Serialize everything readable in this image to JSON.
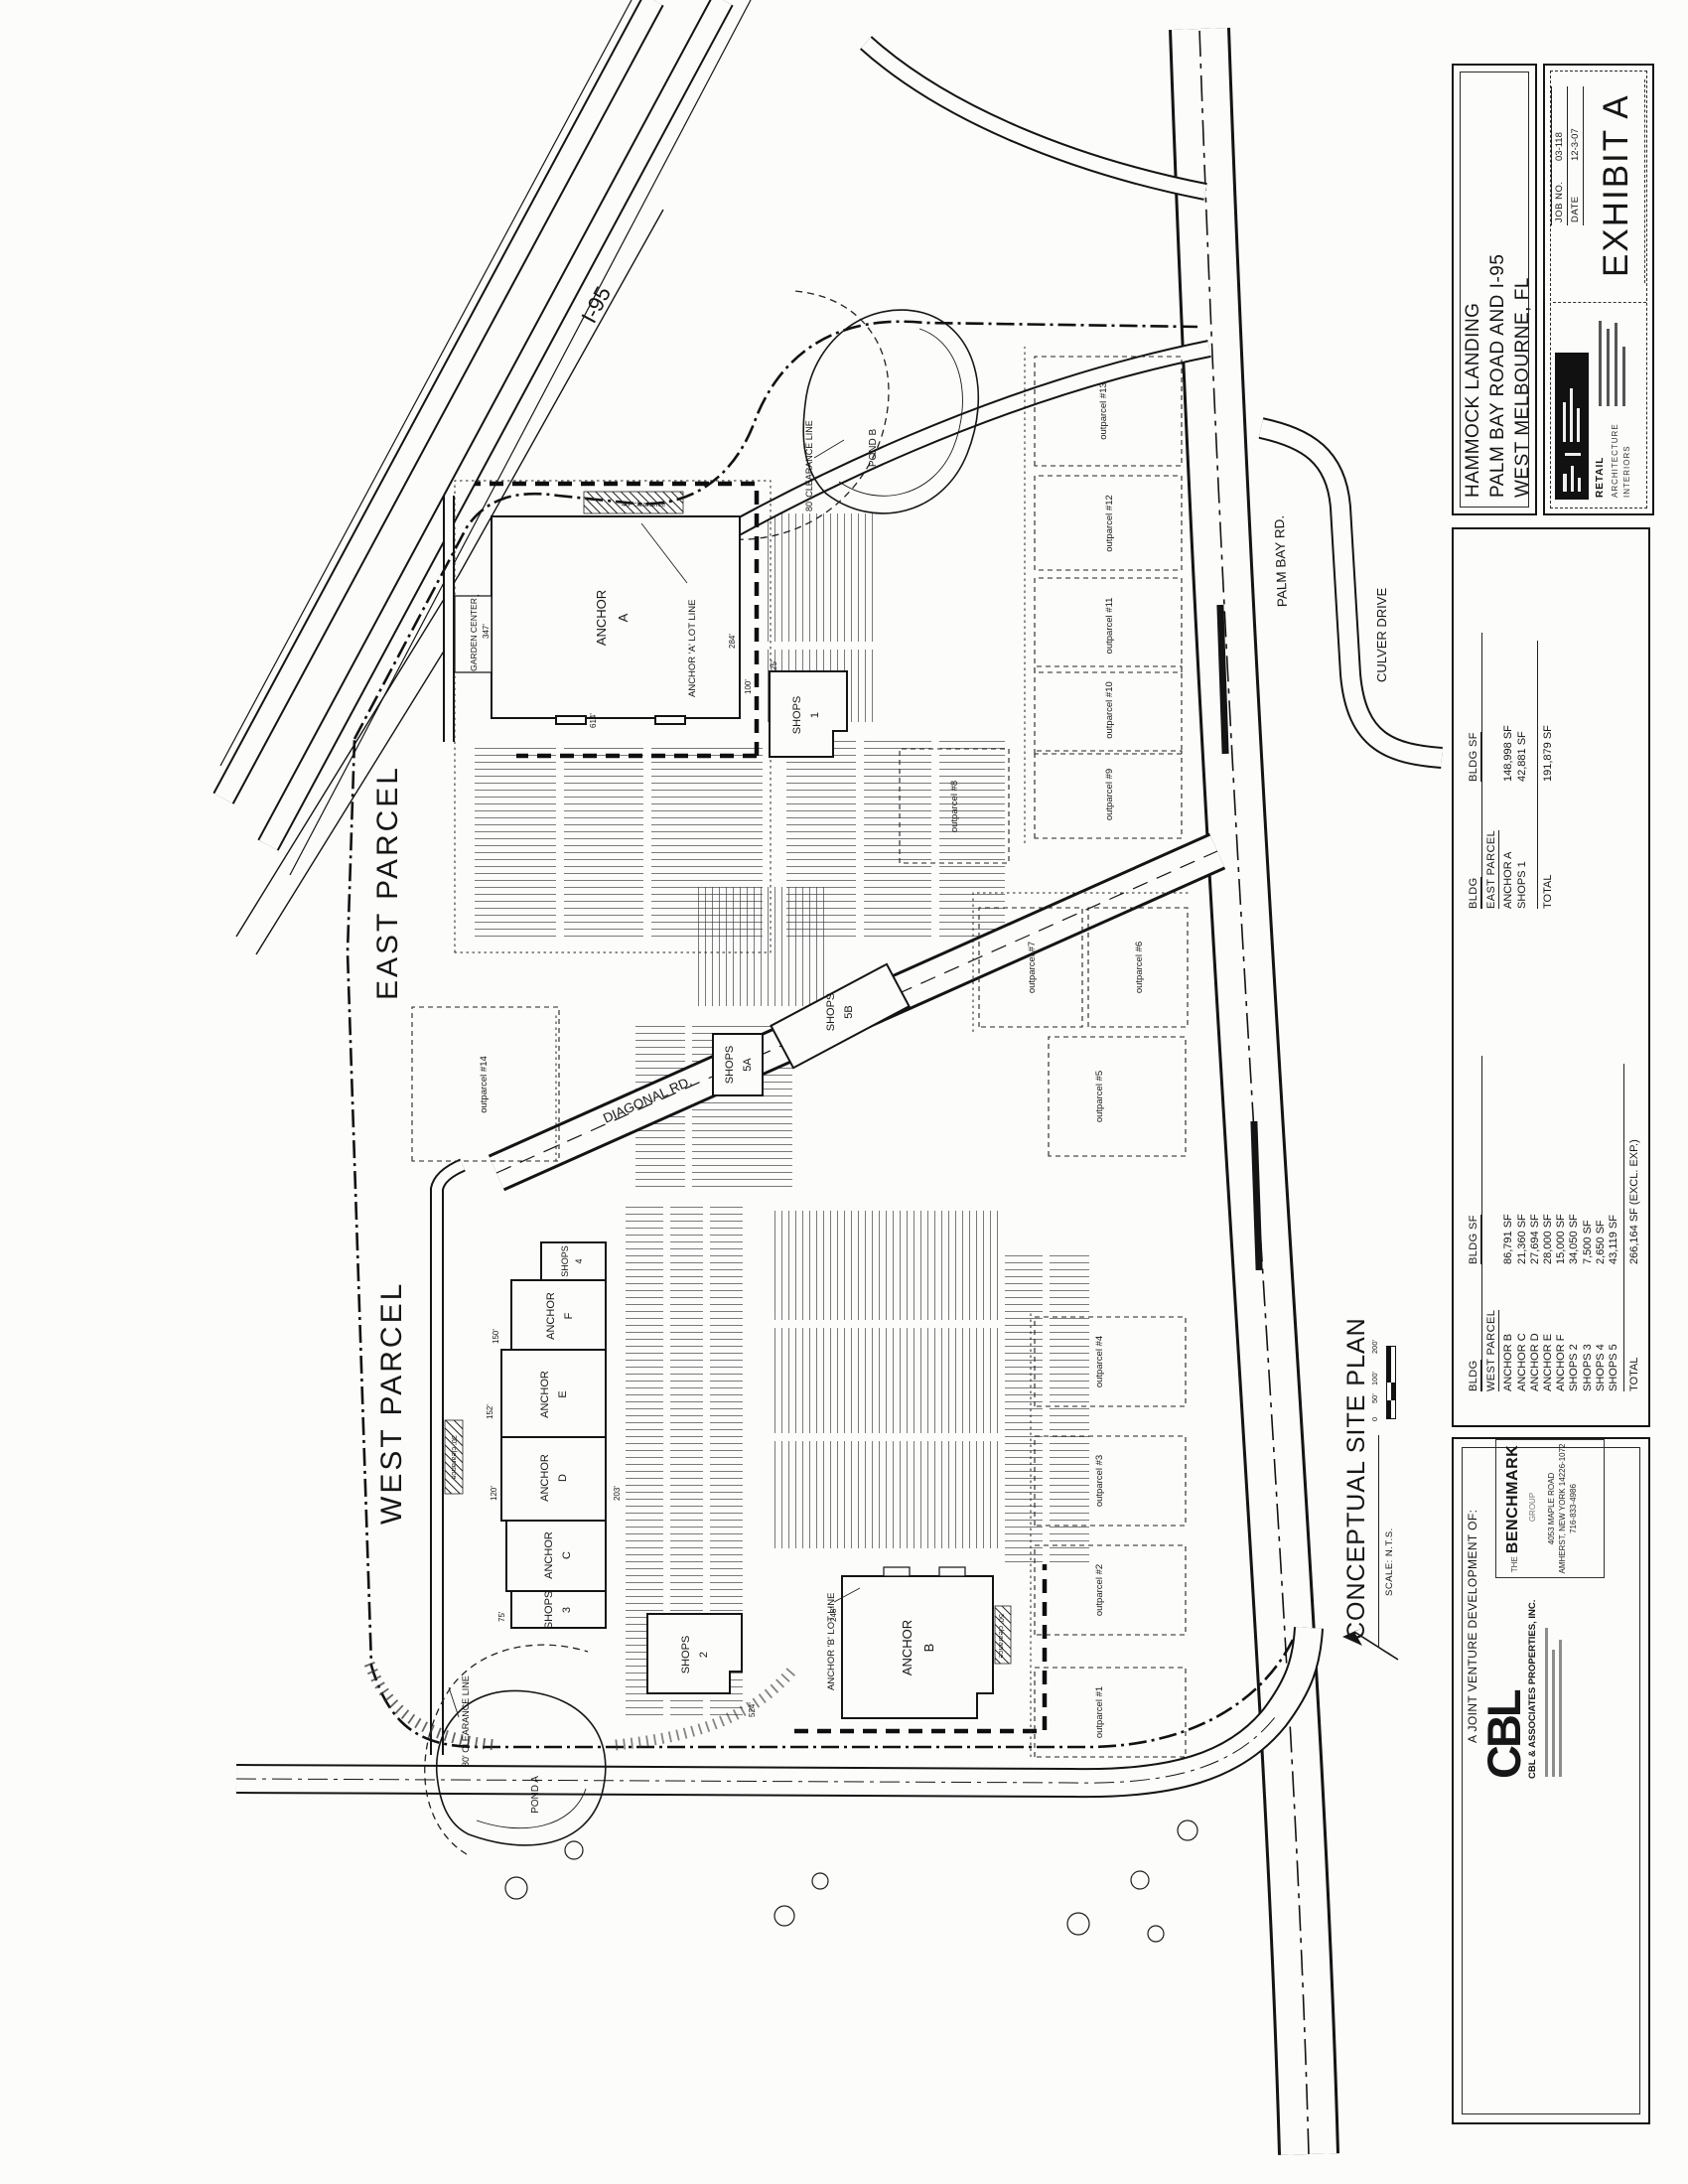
{
  "sheet": {
    "plan_title": "CONCEPTUAL SITE PLAN",
    "plan_scale": "SCALE: N.T.S.",
    "scale_bar": [
      "0",
      "50'",
      "100'",
      "200'"
    ]
  },
  "title_block": {
    "project_lines": [
      "HAMMOCK LANDING",
      "PALM BAY ROAD AND I-95",
      "WEST MELBOURNE, FL"
    ]
  },
  "exhibit_block": {
    "job_no_label": "JOB NO.",
    "job_no": "03-118",
    "date_label": "DATE",
    "date": "12-3-07",
    "exhibit": "EXHIBIT A",
    "architect_words": [
      "RETAIL",
      "ARCHITECTURE",
      "INTERIORS"
    ]
  },
  "developer_block": {
    "header": "A JOINT VENTURE DEVELOPMENT OF:",
    "cbl_logo": "CBL",
    "cbl_name": "CBL & ASSOCIATES PROPERTIES, INC.",
    "benchmark_the": "THE",
    "benchmark_name": "BENCHMARK",
    "benchmark_group": "GROUP",
    "benchmark_addr": [
      "4053 MAPLE ROAD",
      "AMHERST, NEW YORK 14226-1072",
      "716-833-4986"
    ]
  },
  "tables": {
    "west": {
      "col1": "BLDG",
      "col2": "BLDG SF",
      "title": "WEST PARCEL",
      "rows": [
        [
          "ANCHOR B",
          "86,791 SF"
        ],
        [
          "ANCHOR C",
          "21,360 SF"
        ],
        [
          "ANCHOR D",
          "27,694 SF"
        ],
        [
          "ANCHOR E",
          "28,000 SF"
        ],
        [
          "ANCHOR F",
          "15,000 SF"
        ],
        [
          "SHOPS 2",
          "34,050 SF"
        ],
        [
          "SHOPS 3",
          "7,500 SF"
        ],
        [
          "SHOPS 4",
          "2,650 SF"
        ],
        [
          "SHOPS 5",
          "43,119 SF"
        ]
      ],
      "total_label": "TOTAL",
      "total": "266,164 SF (EXCL. EXP.)"
    },
    "east": {
      "col1": "BLDG",
      "col2": "BLDG SF",
      "title": "EAST PARCEL",
      "rows": [
        [
          "ANCHOR A",
          "148,998 SF"
        ],
        [
          "SHOPS 1",
          "42,881 SF"
        ]
      ],
      "total_label": "TOTAL",
      "total": "191,879 SF"
    }
  },
  "map": {
    "parcels": {
      "east": "EAST PARCEL",
      "west": "WEST PARCEL"
    },
    "roads": {
      "i95": "I-95",
      "palm_bay": "PALM BAY RD.",
      "culver": "CULVER DRIVE",
      "diagonal": "DIAGONAL RD."
    },
    "buildings": {
      "anchor_a": [
        "ANCHOR",
        "A"
      ],
      "anchor_b": [
        "ANCHOR",
        "B"
      ],
      "anchor_c": [
        "ANCHOR",
        "C"
      ],
      "anchor_d": [
        "ANCHOR",
        "D"
      ],
      "anchor_e": [
        "ANCHOR",
        "E"
      ],
      "anchor_f": [
        "ANCHOR",
        "F"
      ],
      "shops_1": [
        "SHOPS",
        "1"
      ],
      "shops_2": [
        "SHOPS",
        "2"
      ],
      "shops_3": [
        "SHOPS",
        "3"
      ],
      "shops_4": [
        "SHOPS",
        "4"
      ],
      "shops_5a": [
        "SHOPS",
        "5A"
      ],
      "shops_5b": [
        "SHOPS",
        "5B"
      ],
      "garden_center": "GARDEN CENTER"
    },
    "ponds": {
      "a": "POND A",
      "b": "POND B"
    },
    "clearances": {
      "c80": "80' CLEARANCE LINE",
      "c40": "40' clearance",
      "c30": "30' clearance",
      "c50": "50' clearance"
    },
    "lot_lines": {
      "anchor_a": "ANCHOR 'A' LOT LINE",
      "anchor_b": "ANCHOR 'B' LOT LINE"
    },
    "outparcels": [
      "outparcel #1",
      "outparcel #2",
      "outparcel #3",
      "outparcel #4",
      "outparcel #5",
      "outparcel #6",
      "outparcel #7",
      "outparcel #8",
      "outparcel #9",
      "outparcel #10",
      "outparcel #11",
      "outparcel #12",
      "outparcel #13",
      "outparcel #14"
    ],
    "dims": [
      "347'",
      "614'",
      "284'",
      "100'",
      "25'",
      "150'",
      "152'",
      "120'",
      "75'",
      "248'",
      "524'",
      "203'"
    ]
  }
}
